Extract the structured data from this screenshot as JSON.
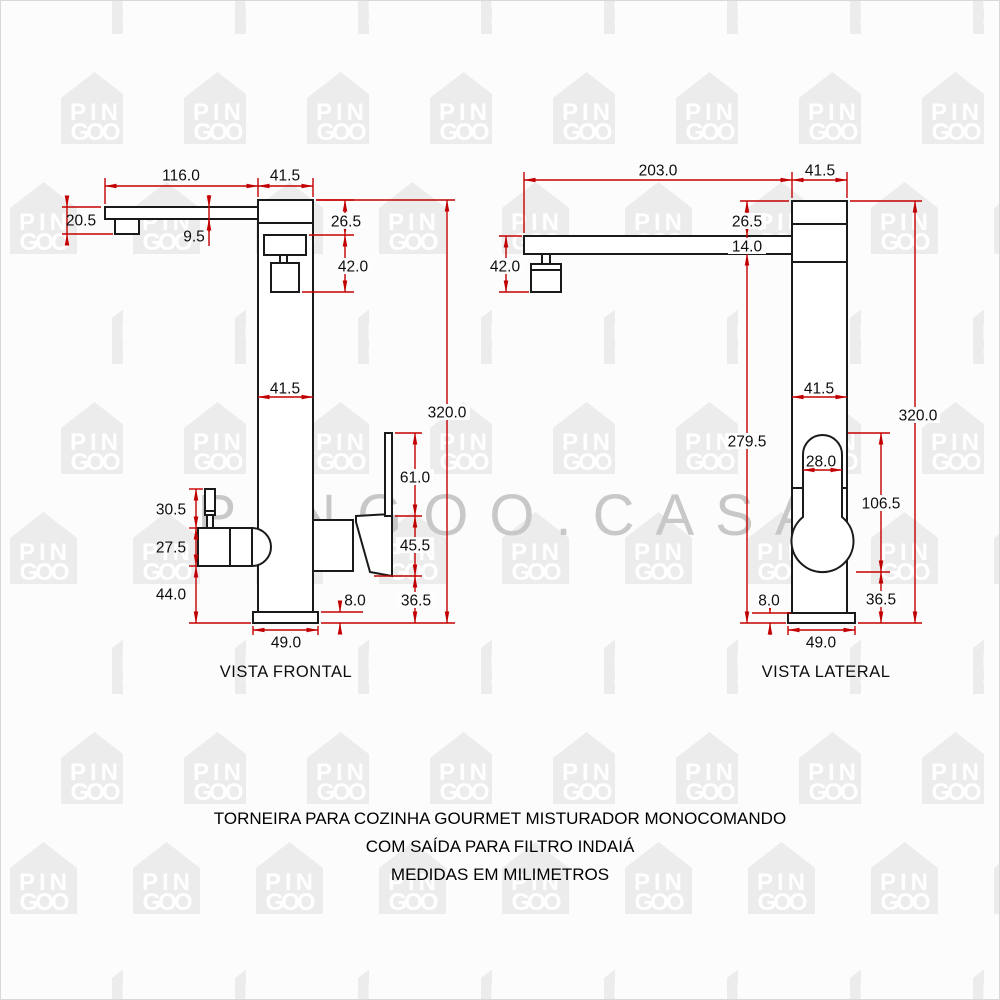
{
  "watermark": {
    "logo_line1": "PIN",
    "logo_line2": "GOO",
    "site_text": "PINGOO.CASA"
  },
  "front_view": {
    "title": "VISTA FRONTAL",
    "dims": {
      "spout_length": "116.0",
      "body_width": "41.5",
      "spout_tip_drop": "20.5",
      "spout_thickness": "9.5",
      "top_section_height": "26.5",
      "outlet_assembly_height": "42.0",
      "body_width_mid": "41.5",
      "total_height": "320.0",
      "lever_height": "61.0",
      "handle_body_height": "45.5",
      "handle_to_base": "36.5",
      "base_height": "8.0",
      "valve_handle_height": "30.5",
      "filter_outlet_height": "27.5",
      "outlet_to_base": "44.0",
      "base_width": "49.0"
    }
  },
  "side_view": {
    "title": "VISTA LATERAL",
    "dims": {
      "spout_reach": "203.0",
      "body_depth": "41.5",
      "top_section_height": "26.5",
      "spout_thickness": "14.0",
      "aerator_drop": "42.0",
      "body_depth_mid": "41.5",
      "below_spout_height": "279.5",
      "handle_width": "28.0",
      "handle_assembly_height": "106.5",
      "total_height": "320.0",
      "handle_to_base": "36.5",
      "base_height": "8.0",
      "base_depth": "49.0"
    }
  },
  "caption": {
    "line1": "TORNEIRA PARA COZINHA GOURMET MISTURADOR MONOCOMANDO",
    "line2": "COM SAÍDA PARA FILTRO INDAIÁ",
    "line3": "MEDIDAS EM MILIMETROS"
  },
  "colors": {
    "dimension_line": "#c30000",
    "drawing_line": "#1a1a1a",
    "watermark_text": "#c8c8c8",
    "watermark_house": "#ececec",
    "background": "#fcfcfc"
  }
}
